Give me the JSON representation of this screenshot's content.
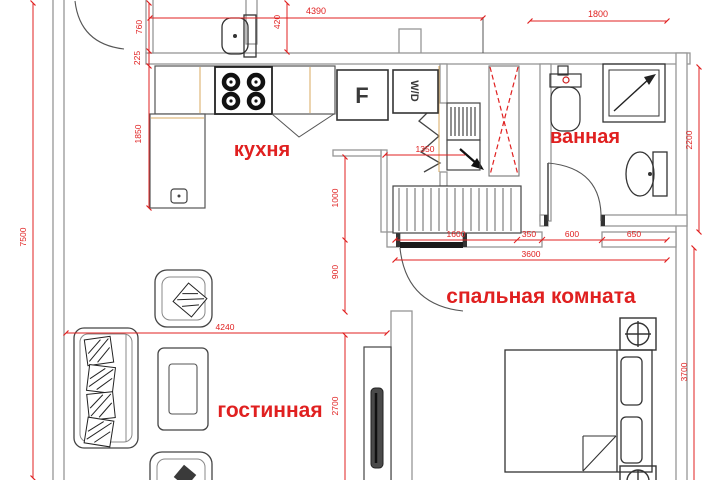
{
  "rooms": {
    "kitchen": "кухня",
    "bathroom": "ванная",
    "bedroom": "спальная комната",
    "living": "гостинная"
  },
  "appliances": {
    "fridge": "F",
    "washer_dryer": "W/D"
  },
  "dims": {
    "d4390": "4390",
    "d1800": "1800",
    "d760": "760",
    "d225": "225",
    "d420": "420",
    "d1850": "1850",
    "d7500": "7500",
    "d1000": "1000",
    "d900": "900",
    "d1350": "1350",
    "d2200": "2200",
    "d1600": "1600",
    "d350": "350",
    "d600": "600",
    "d650": "650",
    "d3600": "3600",
    "d4240": "4240",
    "d2700": "2700",
    "d3700": "3700"
  },
  "colors": {
    "dimension_red": "#e02020",
    "label_red": "#e02020",
    "wall_gray": "#969696",
    "fixture_dark": "#3c3c3c",
    "cabinet_tan": "#d9a95f"
  }
}
